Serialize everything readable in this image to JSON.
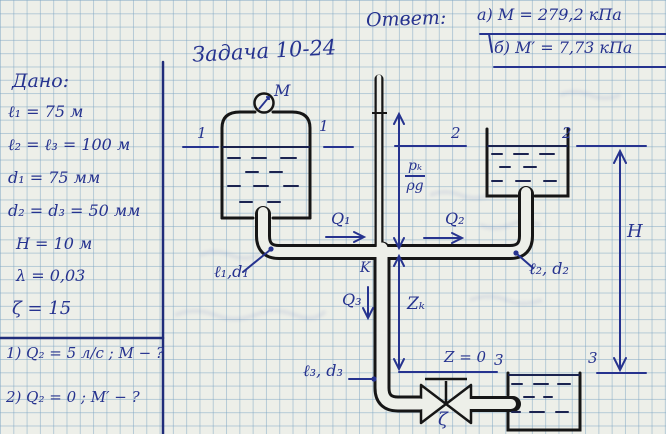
{
  "page": {
    "title": "Задача 10-24"
  },
  "answer": {
    "label": "Ответ:",
    "items": [
      {
        "text": "а) M = 279,2  кПа"
      },
      {
        "text": "б) M′ = 7,73  кПа"
      }
    ]
  },
  "given": {
    "label": "Дано:",
    "items": [
      "ℓ₁ = 75 м",
      "ℓ₂ = ℓ₃ = 100 м",
      "d₁ = 75 мм",
      "d₂ = d₃ = 50 мм",
      "H = 10 м",
      "λ = 0,03",
      "ζ = 15"
    ],
    "questions": [
      "1) Q₂ = 5 л/с ; M − ?",
      "2) Q₂ = 0  ;  M′ − ?"
    ]
  },
  "diagram": {
    "labels": {
      "manometer": "M",
      "section1_left": "1",
      "section1_right": "1",
      "section2_left": "2",
      "section2_right": "2",
      "section3_left": "3",
      "section3_right": "3",
      "q1": "Q₁",
      "q2": "Q₂",
      "q3": "Q₃",
      "k_node": "K",
      "zk": "Zₖ",
      "z_zero": "Z = 0",
      "h_head": "H",
      "pk_num": "pₖ",
      "pk_den": "ρg",
      "pipe1": "ℓ₁,d₁",
      "pipe2": "ℓ₂, d₂",
      "pipe3": "ℓ₃, d₃",
      "valve_zeta": "ζ"
    }
  },
  "colors": {
    "ink_blue": "#26338f",
    "ink_black": "#161616",
    "paper": "#edefe9",
    "grid": "#7da5c3"
  }
}
